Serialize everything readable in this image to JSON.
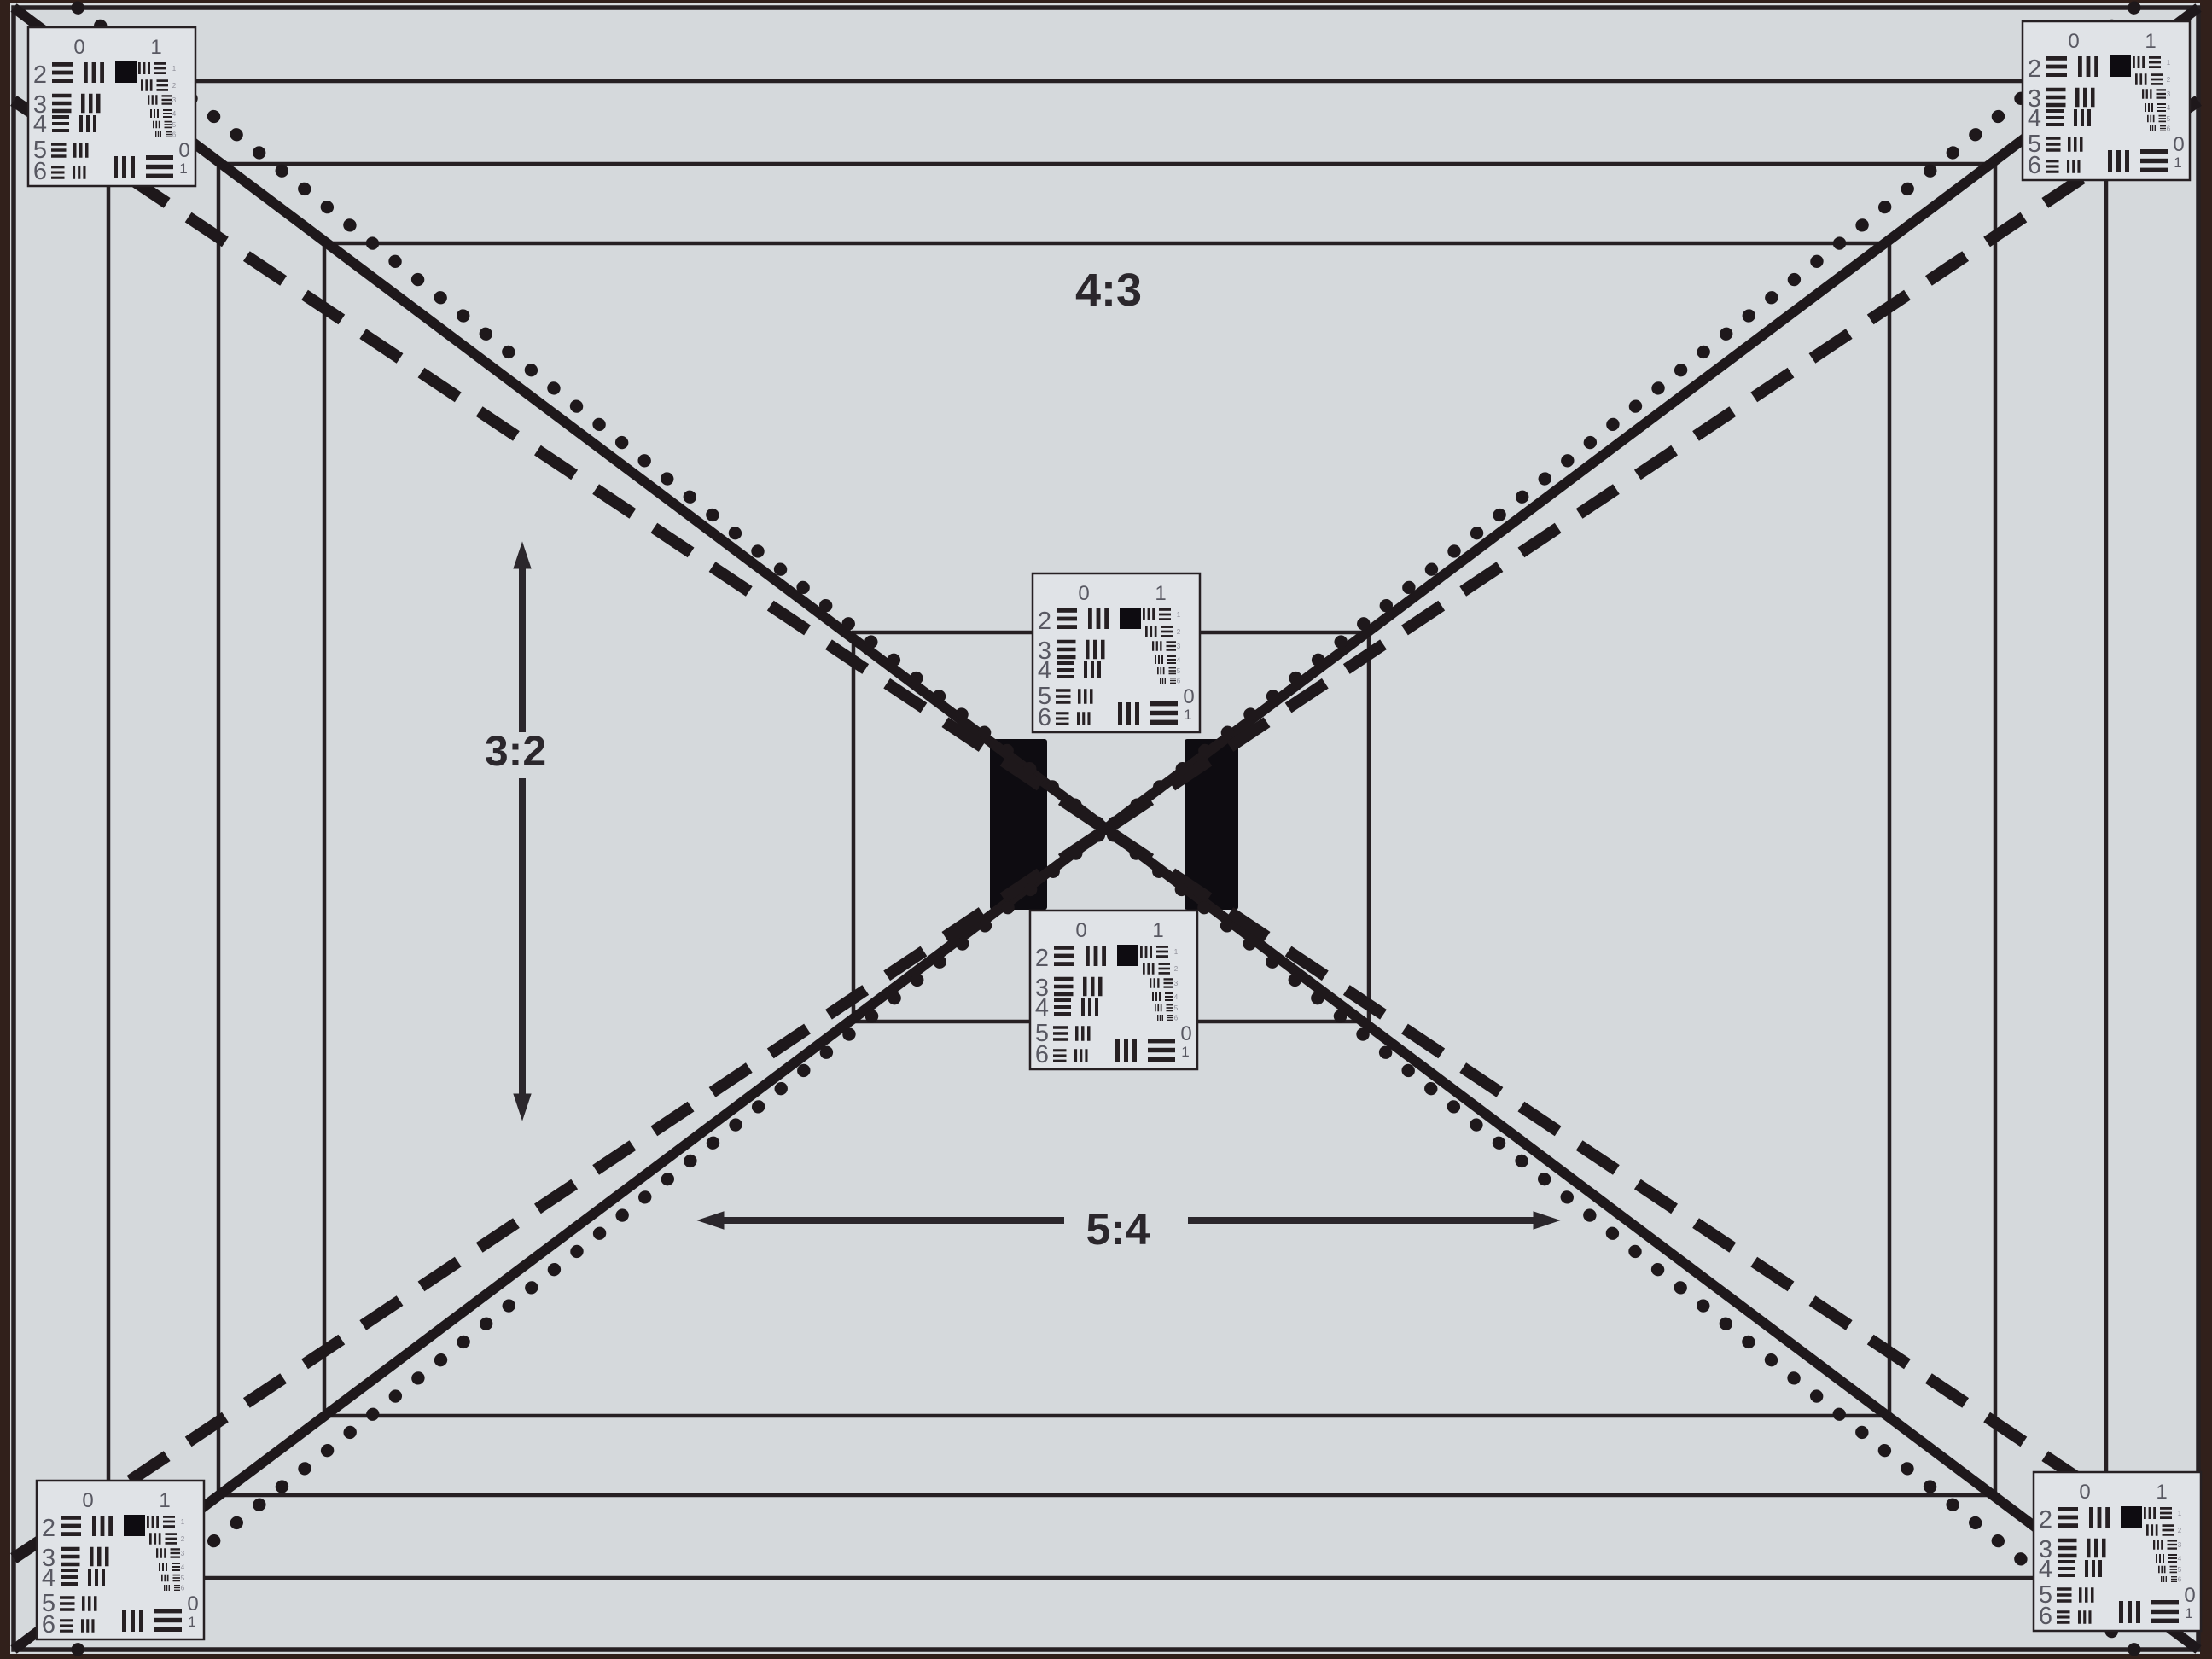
{
  "chart": {
    "description_label": "resolution-test-chart",
    "aspect_labels": [
      {
        "name": "aspect-label-4-3",
        "text": "4:3"
      },
      {
        "name": "aspect-label-3-2",
        "text": "3:2"
      },
      {
        "name": "aspect-label-5-4",
        "text": "5:4"
      }
    ],
    "usaf_card": {
      "top_left_label": "0",
      "top_right_label": "1",
      "row_labels": [
        "2",
        "3",
        "4",
        "5",
        "6"
      ],
      "element_labels": [
        "1",
        "2",
        "3",
        "4",
        "5",
        "6"
      ],
      "corner_zero": "0",
      "corner_one": "1"
    },
    "targets": [
      {
        "name": "usaf-target-top-left"
      },
      {
        "name": "usaf-target-top-right"
      },
      {
        "name": "usaf-target-bottom-left"
      },
      {
        "name": "usaf-target-bottom-right"
      },
      {
        "name": "usaf-target-center-top"
      },
      {
        "name": "usaf-target-center-bottom"
      }
    ],
    "colors": {
      "photo_border": "#31201b",
      "paper": "#d5d9dc",
      "card_fill": "#e0e3e7",
      "line_ink": "#262023",
      "diagonal_ink": "#1e181b",
      "black_patch": "#0e0c11",
      "digit": "#585862",
      "tiny_digit": "#8e8e98",
      "label_ink": "#2b272c"
    }
  }
}
